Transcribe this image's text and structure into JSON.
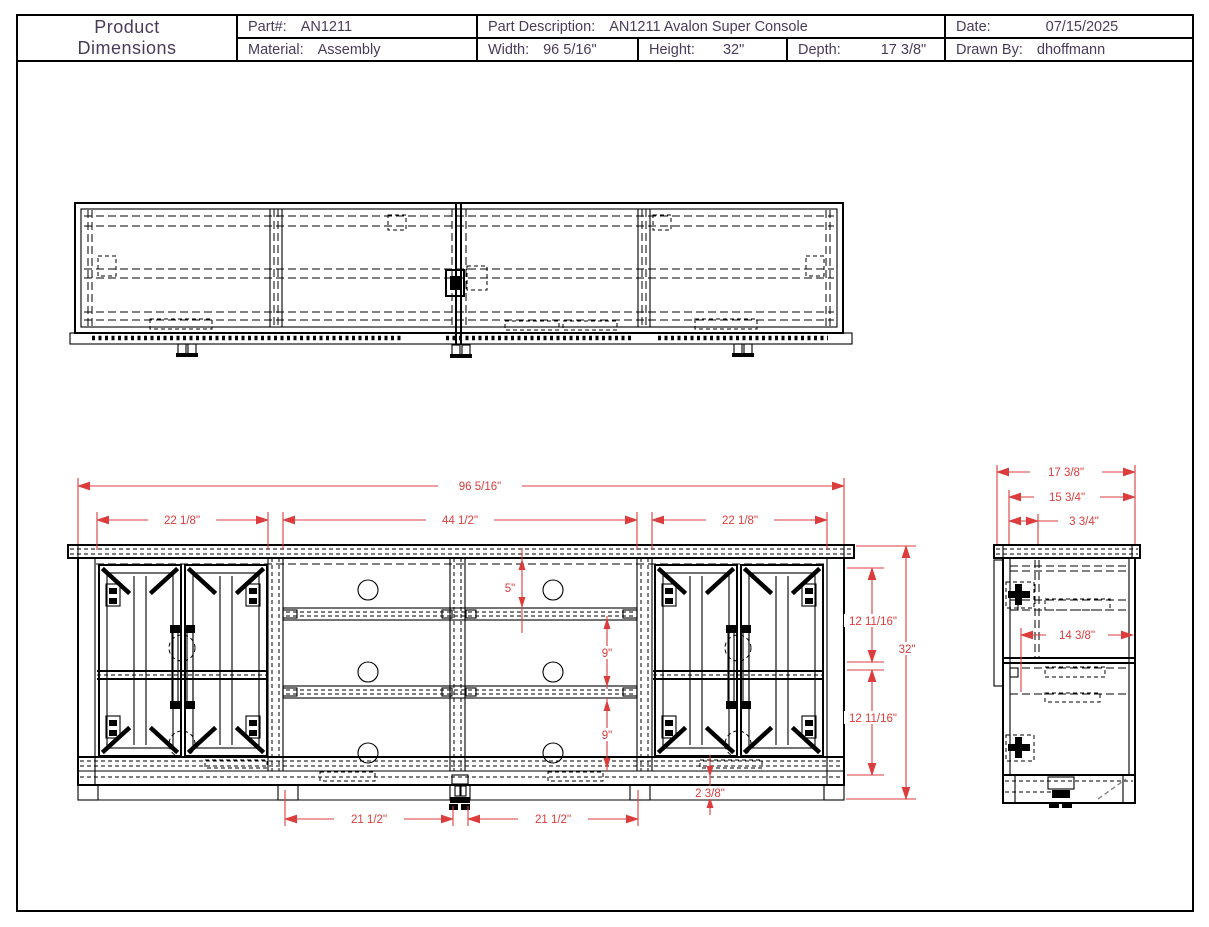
{
  "title_block": {
    "title_line1": "Product",
    "title_line2": "Dimensions",
    "part_label": "Part#:",
    "part_value": "AN1211",
    "material_label": "Material:",
    "material_value": "Assembly",
    "description_label": "Part Description:",
    "description_value": "AN1211 Avalon Super Console",
    "width_label": "Width:",
    "width_value": "96 5/16\"",
    "height_label": "Height:",
    "height_value": "32\"",
    "depth_label": "Depth:",
    "depth_value": "17 3/8\"",
    "date_label": "Date:",
    "date_value": "07/15/2025",
    "drawn_by_label": "Drawn By:",
    "drawn_by_value": "dhoffmann"
  },
  "dims": {
    "front_overall": "96 5/16\"",
    "front_left_section": "22 1/8\"",
    "front_center_section": "44 1/2\"",
    "front_right_section": "22 1/8\"",
    "front_top_opening": "5\"",
    "front_shelf_gap_1": "9\"",
    "front_shelf_gap_2": "9\"",
    "front_upper_opening": "12 11/16\"",
    "front_overall_height": "32\"",
    "front_lower_opening": "12 11/16\"",
    "front_toe_kick": "2 3/8\"",
    "front_leg_span_left": "21 1/2\"",
    "front_leg_span_right": "21 1/2\"",
    "side_overall_depth": "17 3/8\"",
    "side_interior_depth": "15 3/4\"",
    "side_front_inset": "3 3/4\"",
    "side_shelf_depth": "14 3/8\""
  },
  "colors": {
    "line": "#000000",
    "dimension": "#dc3c3c",
    "title_text": "#483b59"
  }
}
